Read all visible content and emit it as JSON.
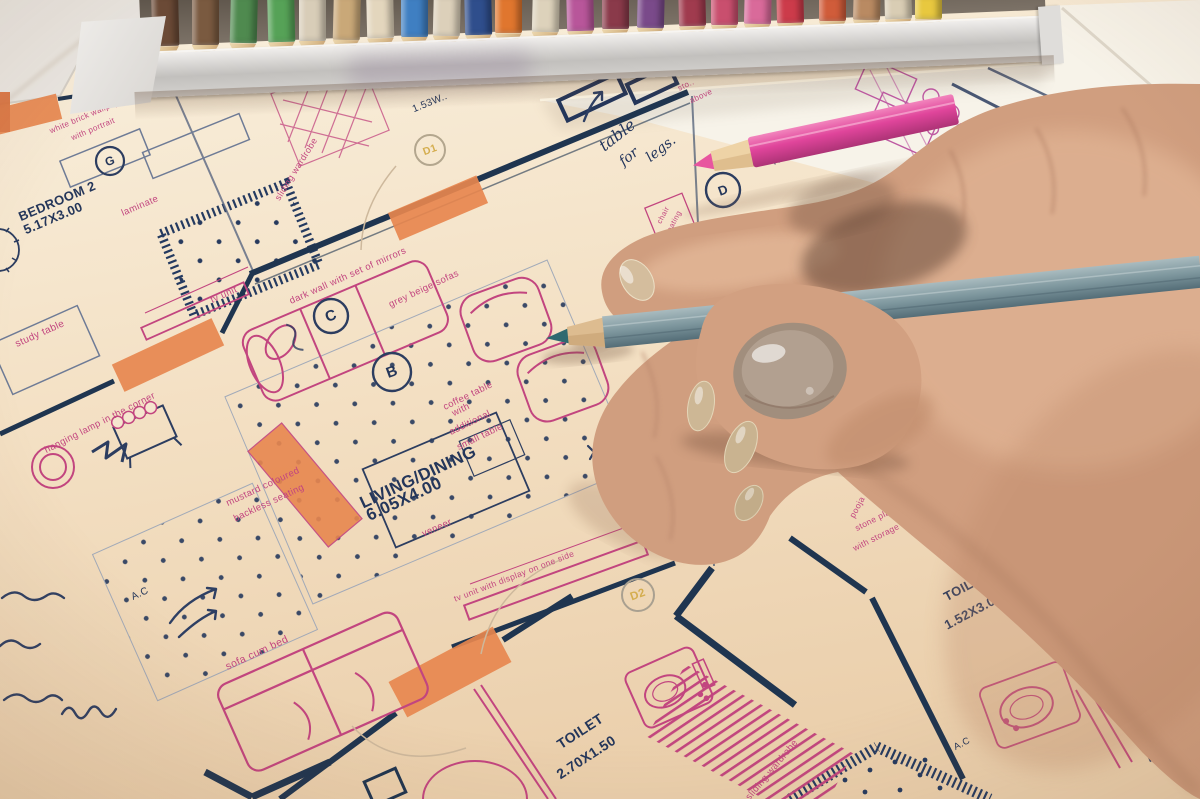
{
  "scene": {
    "description": "Hand holding a grey pencil over an interior floor-plan drawing; box of colored pencils at top; a pink pencil lying on the sheet"
  },
  "plan": {
    "bedroom2_name": "BEDROOM 2",
    "bedroom2_dim": "5.17X3.00",
    "laminate": "laminate",
    "white_brick_1": "white brick wallpaper",
    "white_brick_2": "with portrait",
    "sliding_wardrobe_1": "sliding wardrobe",
    "tv_unit_1": "tv unit",
    "study_table": "study table",
    "dark_wall": "dark wall with set of mirrors",
    "grey_beige": "grey beige sofas",
    "coffee_1": "coffee table",
    "coffee_2": "with",
    "coffee_3": "additional",
    "coffee_4": "small table",
    "living_name": "LIVING/DINING",
    "living_dim": "6.05X4.00",
    "veneer": "veneer",
    "mustard_1": "mustard coloured",
    "mustard_2": "backless seating",
    "hanging_lamp": "hanging lamp in the corner",
    "ac_1": "A.C",
    "sofa_cum_bed": "sofa cum bed",
    "tv_unit_2": "tv unit with display on one side",
    "wallpaper": "wallpaper",
    "toilet1_name": "TOILET",
    "toilet1_dim": "2.70X1.50",
    "sliding_wardrobe_2": "sliding wardrobe",
    "toilet2_name": "TOILET",
    "toilet2_dim": "1.52X3.08",
    "stone_1": "stone platform",
    "stone_2": "with storage below",
    "pooja": "pooja",
    "ac_2": "A.C",
    "chair_1": "chair",
    "chair_2": "seating",
    "dim_153": "1.53W..",
    "kitchen_partial": "Kn",
    "sto": "sto..",
    "above": "above",
    "bottle_unit": "bottle unit",
    "tag_G": "G",
    "tag_B": "B",
    "tag_C": "C",
    "tag_D": "D",
    "tag_D1": "D1",
    "tag_D2": "D2"
  },
  "notes": {
    "hw_table": "table",
    "hw_for": "for",
    "hw_legs": "legs.",
    "hw_carpet": "Carpet"
  },
  "colors": {
    "paper": "#f2e0c6",
    "plan_navy": "#24365a",
    "plan_pink": "#c2457f",
    "door_orange": "#e8874f",
    "skin": "#d09e7f",
    "nail_polish": "#a18e7d",
    "grey_pencil": "#7e979e",
    "pink_pencil": "#e0459b",
    "tray_silver": "#c9c7c4"
  },
  "pencil_tray": {
    "x_positions": [
      165,
      205,
      243,
      281,
      312,
      346,
      380,
      414,
      446,
      478,
      508,
      545,
      580,
      615,
      650,
      692,
      724,
      757,
      790,
      832,
      866,
      898,
      928
    ],
    "pencils": [
      "#6b4a36",
      "#7a5a40",
      "#4f8a4f",
      "#56a257",
      "#d8cdb8",
      "#c9a878",
      "#e3d6bd",
      "#3f7fc2",
      "#dcd0ba",
      "#2f4e8c",
      "#e0762e",
      "#ddd2bb",
      "#b8569a",
      "#8a3a4a",
      "#7a4a8a",
      "#a03b4e",
      "#c94f6e",
      "#d96a9a",
      "#cc3b4a",
      "#d05c3a",
      "#b98a62",
      "#d9cdb4",
      "#e8c83f"
    ]
  }
}
